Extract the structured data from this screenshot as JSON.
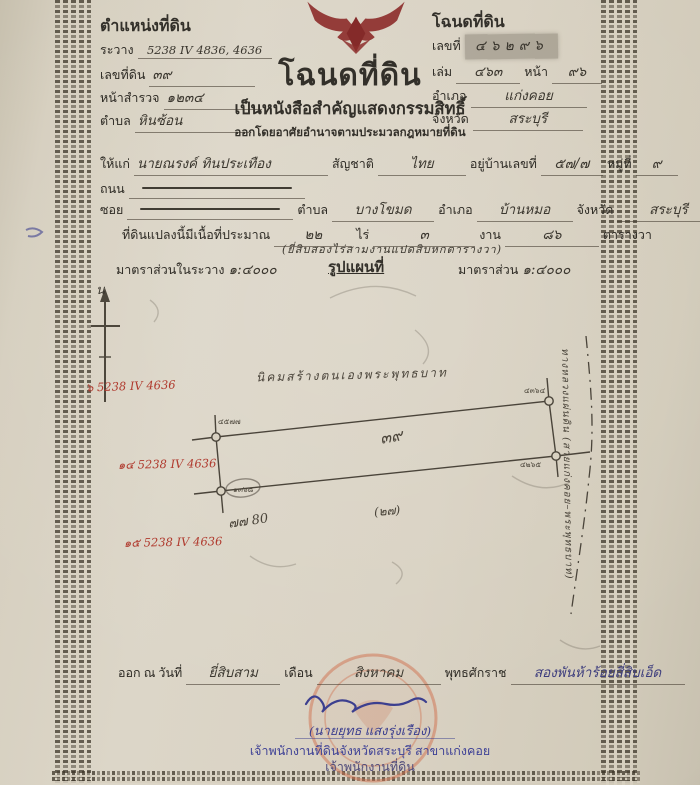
{
  "colors": {
    "paper": "#d8d1c1",
    "ink": "#33302a",
    "accent_red": "#b03a2e",
    "accent_blue": "#3c3f8f",
    "stamp_orange": "#cf6f4e"
  },
  "header_left": {
    "title": "ตำแหน่งที่ดิน",
    "sheet_label": "ระวาง",
    "sheet": "5238 IV 4836, 4636",
    "parcel_label": "เลขที่ดิน",
    "parcel": "๓๙",
    "survey_label": "หน้าสำรวจ",
    "survey": "๑๒๓๔",
    "tambon_label": "ตำบล",
    "tambon": "หินซ้อน"
  },
  "header_right": {
    "title": "โฉนดที่ดิน",
    "doc_no_label": "เลขที่",
    "doc_no": "๔๖๒๙๖",
    "book_label": "เล่ม",
    "book": "๔๖๓",
    "page_label": "หน้า",
    "page": "๙๖",
    "amphoe_label": "อำเภอ",
    "amphoe": "แก่งคอย",
    "province_label": "จังหวัด",
    "province": "สระบุรี"
  },
  "title_block": {
    "main": "โฉนดที่ดิน",
    "sub1": "เป็นหนังสือสำคัญแสดงกรรมสิทธิ์",
    "sub2": "ออกโดยอาศัยอำนาจตามประมวลกฎหมายที่ดิน"
  },
  "grantee": {
    "given_label": "ให้แก่",
    "name": "นายณรงค์ ทินประเทือง",
    "nationality_label": "สัญชาติ",
    "nationality": "ไทย",
    "address_label": "อยู่บ้านเลขที่",
    "address_no": "๕๗/๗",
    "moo_label": "หมู่ที่",
    "moo": "๙",
    "road_label": "ถนน",
    "soi_label": "ซอย",
    "tambon_label": "ตำบล",
    "tambon": "บางโขมด",
    "amphoe_label": "อำเภอ",
    "amphoe": "บ้านหมอ",
    "province_label": "จังหวัด",
    "province": "สระบุรี"
  },
  "area": {
    "prefix": "ที่ดินแปลงนี้มีเนื้อที่ประมาณ",
    "rai": "๒๒",
    "rai_label": "ไร่",
    "ngan": "๓",
    "ngan_label": "งาน",
    "wa": "๘๖",
    "wa_label": "ตารางวา",
    "spelled": "(ยี่สิบสองไร่สามงานแปดสิบหกตารางวา)"
  },
  "scale": {
    "left_label": "มาตราส่วนในระวาง",
    "left_value": "๑:๔๐๐๐",
    "map_title": "รูปแผนที่",
    "right_label": "มาตราส่วน",
    "right_value": "๑:๔๐๐๐"
  },
  "map": {
    "north_label": "น",
    "red_notes": [
      "๖ 5238 IV 4636",
      "๑๔ 5238 IV 4636",
      "๑๕ 5238 IV 4636"
    ],
    "area_label": "นิคมสร้างตนเองพระพุทธบาท",
    "parcel_number": "๓๙",
    "corner_labels": [
      "๔๕๗๗",
      "๔๓๖๔",
      "๔๒๖๕",
      "๑๓๖๘"
    ],
    "bottom_notes": [
      "๗๗ 80",
      "(๒๗)"
    ],
    "road_label": "ทางหลวงแผ่นดิน (สายแก่งคอย–พระพุทธบาท)"
  },
  "issue": {
    "prefix": "ออก ณ วันที่",
    "day": "ยี่สิบสาม",
    "month_label": "เดือน",
    "month": "สิงหาคม",
    "era_label": "พุทธศักราช",
    "year": "สองพันห้าร้อยสี่สิบเอ็ด"
  },
  "signature": {
    "signer_name": "(นายยุทธ แสงรุ่งเรือง)",
    "title_line1": "เจ้าพนักงานที่ดินจังหวัดสระบุรี สาขาแก่งคอย",
    "title_line2": "เจ้าพนักงานที่ดิน"
  }
}
